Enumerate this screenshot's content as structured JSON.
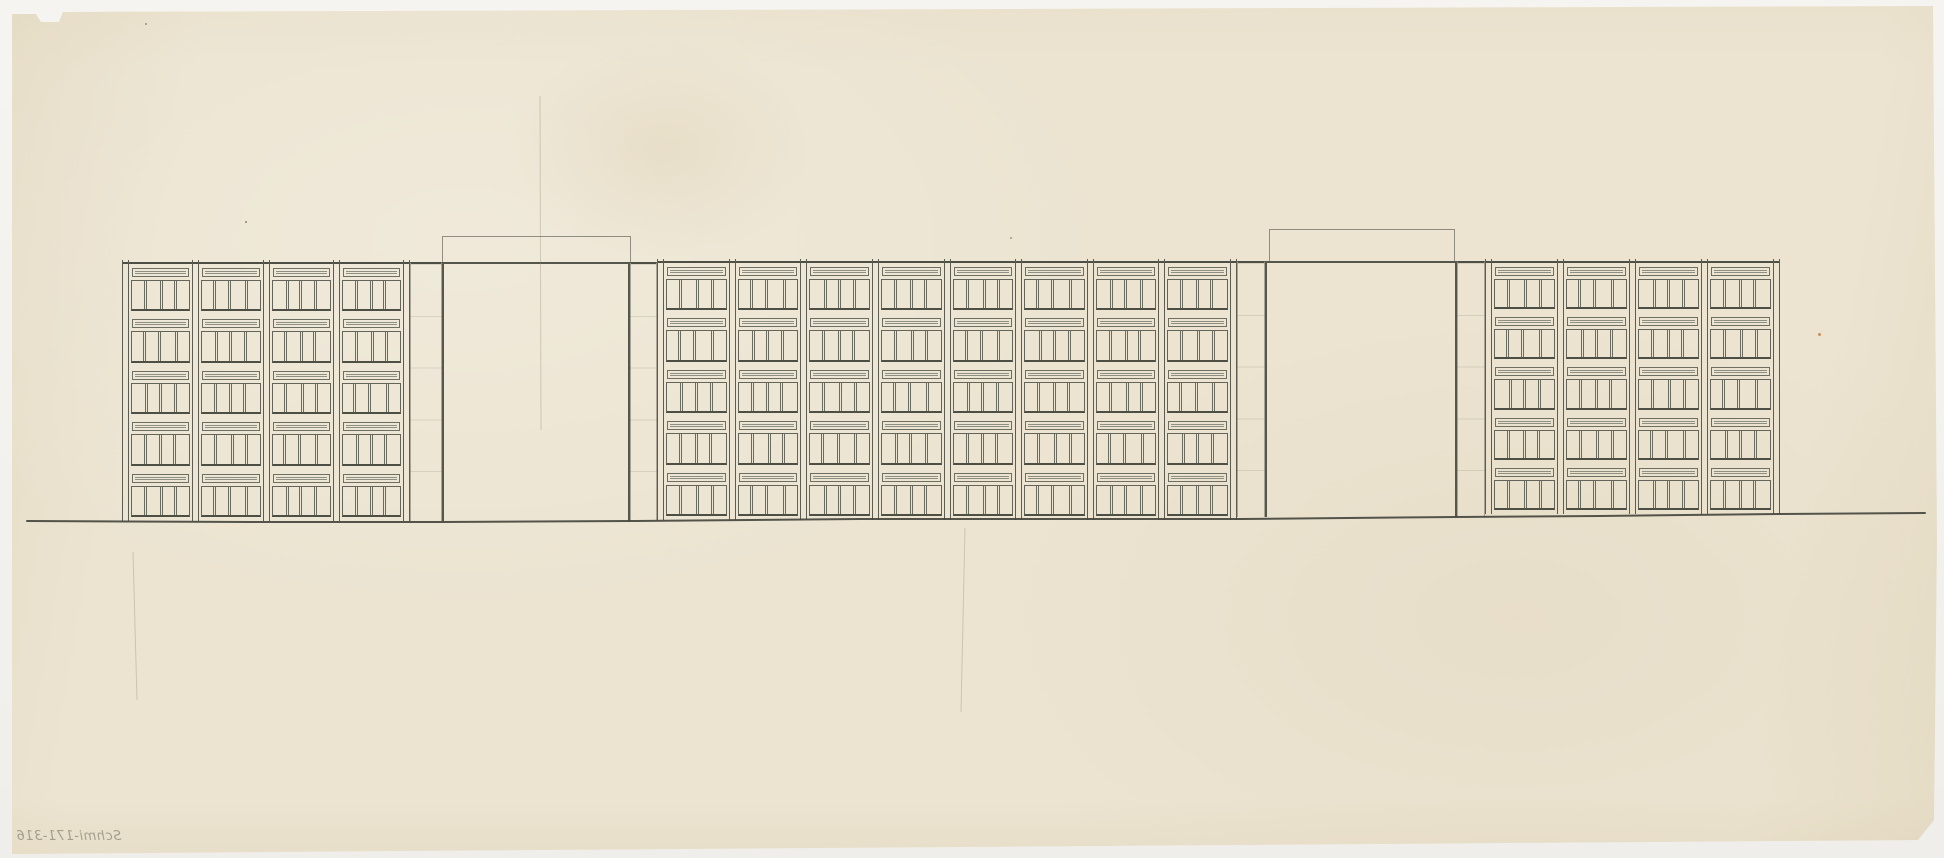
{
  "artwork": {
    "kind": "architectural elevation sketch",
    "medium": "pencil on cream tracing paper",
    "inscription": "Schmi-171-316",
    "inscription_note": "handwritten in pencil, mirrored (reads through verso), lower-left corner"
  },
  "palette": {
    "scan_background": "#f3f2ef",
    "paper": "#ece4d1",
    "paper_stain": "#ccb68a",
    "pencil_dark": "#4d4f45",
    "pencil_mid": "#63655b",
    "pencil_light": "#8d8f82",
    "rust_speck": "#c07a3a"
  },
  "drawing": {
    "floors": 5,
    "pilaster_width": 7,
    "pane_patterns": [
      [
        1,
        1.15,
        0.95,
        1
      ],
      [
        0.9,
        1,
        1.2,
        0.95
      ],
      [
        1.1,
        0.9,
        1,
        1.05
      ],
      [
        1,
        1.05,
        0.9,
        1.15
      ]
    ],
    "blocks": [
      {
        "id": "left",
        "x": 122,
        "top": 262,
        "bottom": 521,
        "width": 288,
        "bays": 4
      },
      {
        "id": "middle",
        "x": 657,
        "top": 261,
        "bottom": 520,
        "width": 580,
        "bays": 8
      },
      {
        "id": "right",
        "x": 1485,
        "top": 261,
        "bottom": 514,
        "width": 295,
        "bays": 4
      }
    ],
    "gateways": [
      {
        "id": "left-gateway",
        "top": 262,
        "bottom": 521,
        "wall_left": {
          "x": 410,
          "width": 32
        },
        "opening": {
          "x": 442,
          "width": 188
        },
        "parapet": {
          "x": 442,
          "width": 189,
          "top": 236
        },
        "wall_right": {
          "x": 630,
          "width": 27
        }
      },
      {
        "id": "right-gateway",
        "top": 261,
        "bottom": 517,
        "wall_left": {
          "x": 1237,
          "width": 28
        },
        "opening": {
          "x": 1265,
          "width": 192
        },
        "parapet": {
          "x": 1269,
          "width": 186,
          "top": 229
        },
        "wall_right": {
          "x": 1457,
          "width": 28
        }
      }
    ],
    "ground_line": {
      "points": [
        [
          27,
          521
        ],
        [
          250,
          522
        ],
        [
          442,
          522
        ],
        [
          630,
          521
        ],
        [
          860,
          519
        ],
        [
          1100,
          519
        ],
        [
          1240,
          519
        ],
        [
          1457,
          517
        ],
        [
          1600,
          516
        ],
        [
          1780,
          514
        ],
        [
          1925,
          513
        ]
      ]
    },
    "creases": [
      {
        "x1": 540,
        "y1": 96,
        "x2": 541,
        "y2": 430
      },
      {
        "x1": 133,
        "y1": 552,
        "x2": 137,
        "y2": 700
      },
      {
        "x1": 965,
        "y1": 528,
        "x2": 961,
        "y2": 712
      }
    ],
    "specks": [
      {
        "x": 245,
        "y": 221,
        "size": 2,
        "color": "#6a6a60"
      },
      {
        "x": 145,
        "y": 23,
        "size": 2,
        "color": "#7a7a70"
      },
      {
        "x": 1010,
        "y": 237,
        "size": 2,
        "color": "#8a8a7e"
      },
      {
        "x": 1818,
        "y": 333,
        "size": 3,
        "color": "#c07a3a"
      }
    ]
  }
}
